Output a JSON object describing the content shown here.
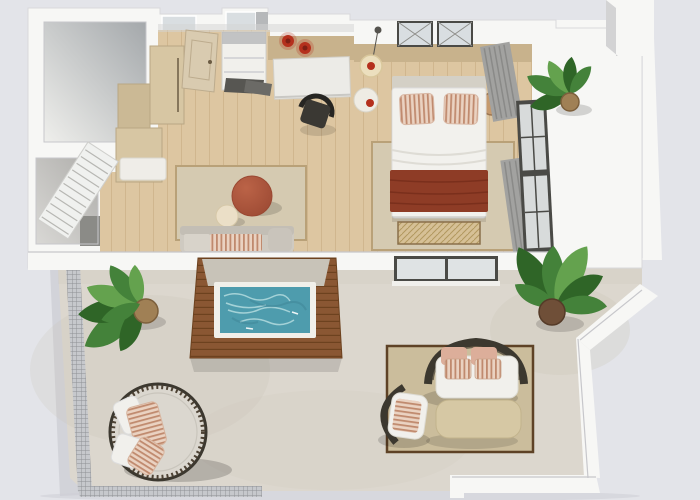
{
  "scene": {
    "type": "3d-floor-plan-render",
    "view": "top-down",
    "rooms": [
      "bathroom",
      "entry-hall",
      "utility-room",
      "kitchenette",
      "living-area",
      "bedroom",
      "pool-deck",
      "main-terrace",
      "side-balcony"
    ],
    "furniture": [
      "entry-door",
      "shelf-niche",
      "desk",
      "desk-chair",
      "double-bed",
      "bed-bench",
      "nightstands",
      "bedside-lamps",
      "pendant-lamp",
      "terracotta-pouf",
      "side-table",
      "indoor-sofa",
      "louver-panel",
      "wardrobe-cabinets",
      "plunge-pool",
      "outdoor-sofa",
      "outdoor-armchair",
      "coffee-table",
      "round-daybed",
      "balcony-stools",
      "potted-plants"
    ]
  },
  "colors": {
    "bg": "#e3e4e9",
    "shadow_ext": "#cdced5",
    "wall": "#f7f7f5",
    "wall_edge": "#c7c7cb",
    "wall_face": "#d3d3d4",
    "room_light": "#efefec",
    "room_dark": "#a4a8ab",
    "room2_light": "#d9d8d5",
    "room2_dark": "#aeadaa",
    "niche_dark": "#8b8b87",
    "shaft_gray": "#b6b8ba",
    "glass_frost": "#d9dee1",
    "glass_pane": "#dfe3e4",
    "frame_dark": "#4a4a46",
    "floor_wood": "#ddc6a1",
    "floor_wood_line": "#c5a97d",
    "terrace_floor": "#dcd7ce",
    "terrace_mottle": "#c9c2b5",
    "balcony_floor": "#d8d3ca",
    "rug": "#d5cab1",
    "rug_border": "#b9a178",
    "rug_out": "#cbbd9c",
    "rug_out_border": "#5e4226",
    "pool": "#4e9cad",
    "pool_deep": "#3d8496",
    "pool_ripple": "#c2e4e6",
    "deck": "#8a5733",
    "deck_line": "#6d421f",
    "deck_slab": "#c8c3b8",
    "rim_white": "#f1f0ea",
    "pouf_light": "#bb6347",
    "pouf_dark": "#9a4832",
    "side_table": "#ebdfc7",
    "sofa_base": "#cfcac1",
    "sofa_back": "#c3beb5",
    "sofa_cushion": "#d8d3ca",
    "sofa_arm": "#c9c4bb",
    "pillow_base": "#ead2c1",
    "pillow_stripe": "#c08a6e",
    "blush": "#dcae9a",
    "bed": "#f2f1ed",
    "headboard": "#d4d0c6",
    "sheet_line": "#dedcd5",
    "throw": "#8e3c26",
    "throw_line": "#7a2f1c",
    "bench": "#d6c096",
    "bench_line": "#b2985f",
    "wood_panel": "#c8b28c",
    "cabinet": "#d7c6a3",
    "cabinet2": "#cbb995",
    "counter": "#efede8",
    "handle": "#6b5b43",
    "door": "#d9cbb0",
    "door_edge": "#bcab8d",
    "louver": "#f0f1ef",
    "louver_line": "#b7b7b3",
    "red": "#b5301d",
    "red_dark": "#7e1f14",
    "lamp": "#ecdfbe",
    "lamp_edge": "#d9c79c",
    "nightstand": "#efece4",
    "stool_tan": "#c59a6e",
    "stool_tan_ring": "#9a7450",
    "curtain": "#a2a2a0",
    "curtain_line": "#8a8a88",
    "rattan": "#3c382f",
    "rattan_hi": "#6b6250",
    "daybed_cushion": "#dbd7cf",
    "daybed_ring": "#c9c5bc",
    "rope": "#4e4335",
    "stool_cream": "#e8dec4",
    "stool_cream_ring": "#cfc2a2",
    "table_out": "#d6c8a4",
    "table_out_edge": "#c2b38c",
    "leaf_dark": "#2f6527",
    "leaf_mid": "#44823a",
    "leaf_light": "#64a24e",
    "pot_rattan": "#a08055",
    "pot_rattan_rim": "#7c5f3c",
    "pot_dark": "#6f4f38",
    "railing_base": "#c6c8cc",
    "railing_line": "#8e9094",
    "white_soft": "#f1f0ec"
  }
}
